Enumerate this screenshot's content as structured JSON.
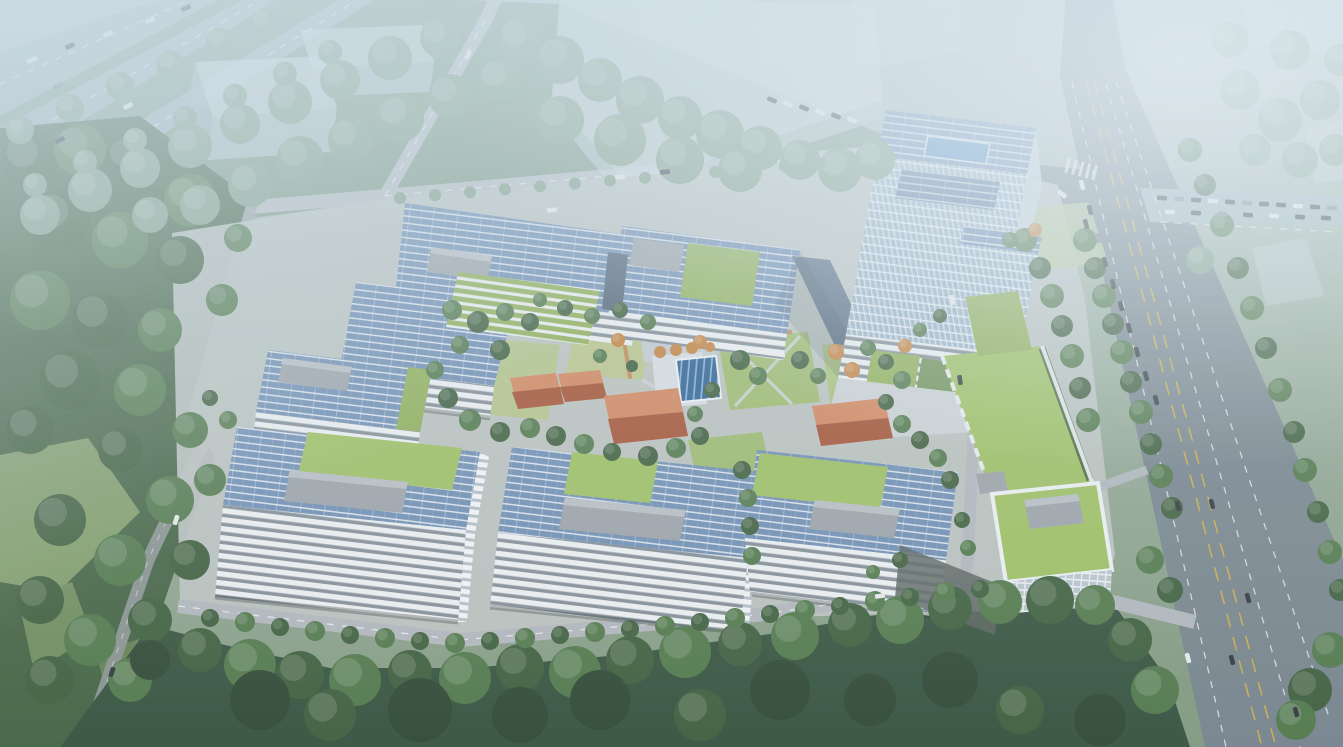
{
  "scene": {
    "type": "aerial-architectural-rendering",
    "subject": "Hazy bird's-eye rendering of a technology office campus: white office blocks with rooftop solar arrays and green roofs around a landscaped courtyard with terracotta pavilions and a glazed pool skylight, an east glass high-rise, translucent future-phase massing blocks to the north, dense tree belts and an arterial road with yellow lane lines on the right"
  },
  "palette": {
    "skyTop": "#b7c6cb",
    "groundMid": "#a2b4a6",
    "groundLow": "#81987d",
    "solarBlue": "#6d8cb1",
    "solarDark": "#5c7a9e",
    "facadeWhite": "#edf0f1",
    "facadeDark": "#828c94",
    "glassBlue": "#a0b7c8",
    "greenRoof": "#8fae54",
    "greenBright": "#9cbf5e",
    "lawn": "#9db96b",
    "lawnLight": "#b3c387",
    "lawnHazy": "#b6c898",
    "treeDark": "#3c5c39",
    "treeMid": "#4f7647",
    "treeLight": "#6b9156",
    "treeHazy": "#7f9c82",
    "treeShadow": "#2c4530",
    "autumn": "#c5823e",
    "terracottaLight": "#d3845a",
    "terracottaDark": "#a44f30",
    "roadAsphalt": "#75828a",
    "roadLight": "#b4bac0",
    "roadHazy": "#9fb2ba",
    "laneYellow": "#d8b13c",
    "poolBlue": "#2e5f90",
    "poolDeck": "#d8dde0",
    "walkway": "#c08850",
    "ghost": "#ccd6dc",
    "penthouse": "#9aa1a6",
    "campusPlate": "#bdc3c0",
    "carDark": "#2e3438",
    "carWhite": "#e9ebec",
    "carGray": "#7a8187"
  },
  "inventory": {
    "office_buildings": [
      {
        "id": "nw-l-shaped-block",
        "roof": "solar-panels",
        "features": [
          "terraced-green-atrium",
          "rooftop-plant-room"
        ]
      },
      {
        "id": "north-block",
        "roof": "solar-panels",
        "features": [
          "green-roof-court",
          "dark-pv-link"
        ]
      },
      {
        "id": "east-highrise-tower",
        "roof": "solar-panels",
        "features": [
          "glass-curtain-wall",
          "blue-skylight",
          "green-podium"
        ]
      },
      {
        "id": "west-small-block",
        "roof": "solar-panels",
        "features": [
          "green-roof-strip",
          "plant-room"
        ]
      },
      {
        "id": "sw-block",
        "roof": "solar-panels",
        "features": [
          "large-green-roof",
          "plant-room"
        ]
      },
      {
        "id": "south-block",
        "roof": "solar-panels",
        "features": [
          "green-roof-patch",
          "plant-room"
        ]
      },
      {
        "id": "se-block",
        "roof": "solar-panels",
        "features": [
          "green-roof-patch",
          "plant-room"
        ]
      },
      {
        "id": "east-green-roof-block",
        "roof": "extensive-green-roof",
        "features": [
          "white-frame-annex",
          "glazed-base",
          "hedge-parapet"
        ]
      }
    ],
    "courtyard": {
      "terracotta_pavilions": 4,
      "pool_skylight": 1,
      "lawn_plots": "multiple",
      "autumn_trees": true,
      "elevated_orange_walkway": true
    },
    "context": {
      "ghost_massing_blocks": 5,
      "arterial_road_with_yellow_lines": true,
      "tree_lined_streets": true,
      "diagonal_avenues_top_left": 3,
      "vehicles_visible": true
    }
  }
}
